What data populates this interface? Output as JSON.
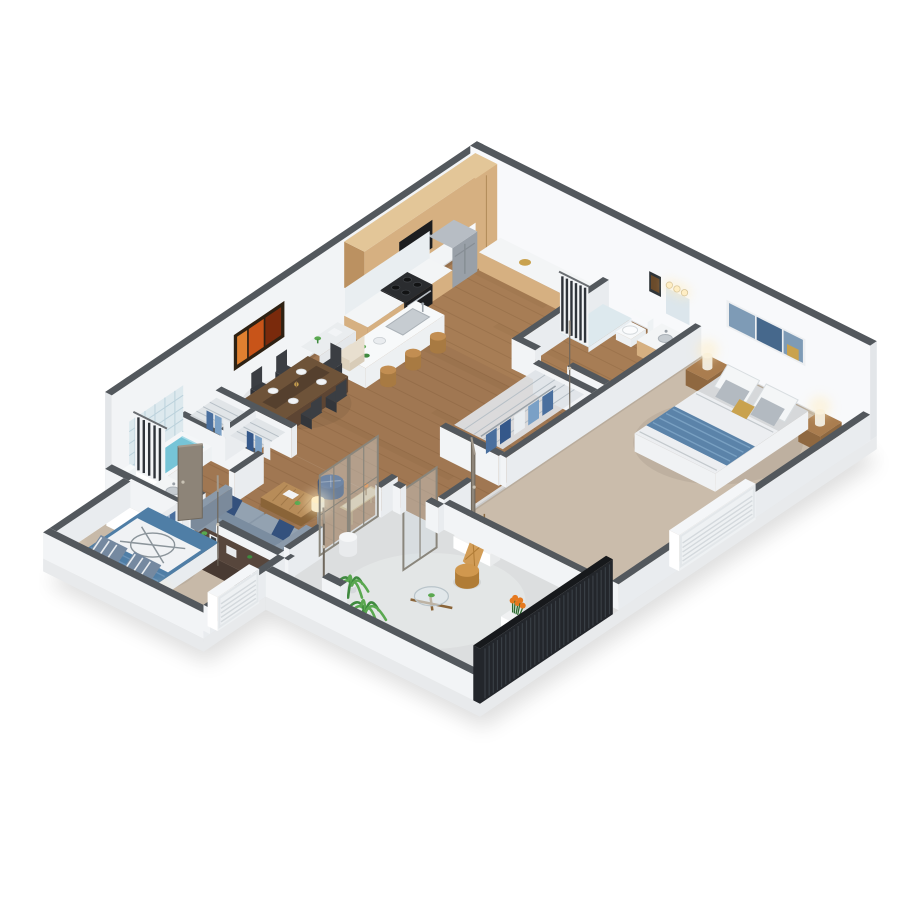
{
  "scene": {
    "kind": "3d-isometric-floor-plan-render",
    "background": "#ffffff",
    "palette": {
      "wallCap": "#53585d",
      "wallFace": "#f2f4f6",
      "wallFaceLit": "#f8f9fb",
      "wallInner": "#e9ecef",
      "wallSide": "#e3e6e9",
      "slabSide": "#e8eaec",
      "wood": "#a07752",
      "woodLite": "#c79a62",
      "woodLine": "#6b4a2a",
      "woodDark": "#7a5635",
      "carpet1": "#cabcab",
      "carpet2": "#c7b9a8",
      "concrete": "#dcdedf",
      "concreteLit": "#eaeceb",
      "oak": "#d6b081",
      "oakLight": "#e3c698",
      "oakDark": "#bb9161",
      "counter": "#f3f5f6",
      "steel": "#b7bdc4",
      "steelDark": "#99a0a8",
      "range": "#1c1d1f",
      "rangeTop": "#2a2c2f",
      "islandSide": "#edf0f2",
      "islandTop": "#f7f9fa",
      "sinkSteel": "#c6ccd1",
      "stool": "#c28e52",
      "stoolDark": "#a87a42",
      "tableWood": "#5d4533",
      "tableTop": "#6e5339",
      "chairDark": "#3b3e43",
      "marble": "#eaedef",
      "cream": "#e8dfcf",
      "sofaBase": "#8b9aaa",
      "sofaBack": "#7b8da0",
      "sofaSeat": "#93a2b1",
      "pillowNavy": "#34517d",
      "poufNavy": "#2e4d7e",
      "coffeeWood": "#b78c59",
      "coffeeDark": "#8a6438",
      "gold": "#ab8c60",
      "dresser": "#483a32",
      "dresserTop": "#57463c",
      "bedGray": "#d6d8da",
      "bedWhite": "#f0f2f4",
      "pillowWhite": "#f4f6f7",
      "pillowGray": "#b3bac1",
      "throwBlue": "#5b83a9",
      "blanketBlue": "#4f7ea6",
      "compassLine": "#8b949a",
      "pillowStripe": "#7589a0",
      "nstand": "#aa7d4f",
      "nstandDark": "#8f6840",
      "lampGlow": "#ffeec4",
      "lampWhite": "#f7f3ea",
      "door": "#8d8478",
      "doorDark": "#6f675c",
      "doorLight": "#a39a8d",
      "fence": "#23262b",
      "fenceHi": "#3e444b",
      "fenceCap": "#17191c",
      "water": "#76c4d7",
      "tile": "#dde9ee",
      "tileLine": "#bcd2dc",
      "curtainDark": "#2f343a",
      "curtainWhite": "#f2f4f6",
      "wire": "#dfe3e7",
      "wireLine": "#b6bfc6",
      "clothes": [
        "#4a6f9e",
        "#7aa0c6",
        "#e9edf0",
        "#35588a"
      ],
      "green": "#3f8a3f",
      "green2": "#5aa850",
      "greenDark": "#2e6b30",
      "flower": "#e5791f",
      "rattan": "#d0984e",
      "rattanDark": "#b07c36",
      "branch": "#8a6a42",
      "artOrange": [
        "#7a2a0c",
        "#c85419",
        "#e08030"
      ],
      "artOrangeFrame": "#2e2113",
      "artBlue": [
        "#7e9bb6",
        "#46688c",
        "#c9a24e"
      ],
      "artBlueFrame": "#edeff1",
      "mirror": "#dce6ec",
      "glass": "#d3dce0",
      "screenFrame": "#8a867c"
    },
    "rooms": [
      {
        "id": "kitchen",
        "name": "Kitchen"
      },
      {
        "id": "dining-area",
        "name": "Dining Area"
      },
      {
        "id": "living-room",
        "name": "Living Room"
      },
      {
        "id": "hallway",
        "name": "Hallway"
      },
      {
        "id": "bathroom-1",
        "name": "Bathroom 1"
      },
      {
        "id": "bathroom-2",
        "name": "Bathroom 2"
      },
      {
        "id": "hall-closet",
        "name": "Walk-in Closet"
      },
      {
        "id": "linen-closets",
        "name": "Linen Closets"
      },
      {
        "id": "master-bedroom",
        "name": "Master Bedroom"
      },
      {
        "id": "bedroom-2",
        "name": "Bedroom 2"
      },
      {
        "id": "entry",
        "name": "Entry"
      },
      {
        "id": "patio",
        "name": "Patio"
      }
    ],
    "furniture": [
      {
        "id": "refrigerator",
        "room": "kitchen"
      },
      {
        "id": "range-oven",
        "room": "kitchen"
      },
      {
        "id": "kitchen-cabinets",
        "room": "kitchen"
      },
      {
        "id": "upper-cabinets",
        "room": "kitchen"
      },
      {
        "id": "kitchen-island-with-sink",
        "room": "kitchen"
      },
      {
        "id": "bar-stools",
        "room": "kitchen",
        "count": 3
      },
      {
        "id": "writing-desk",
        "room": "dining-area"
      },
      {
        "id": "desk-chair",
        "room": "dining-area"
      },
      {
        "id": "dining-table",
        "room": "dining-area"
      },
      {
        "id": "dining-chairs",
        "room": "dining-area",
        "count": 6
      },
      {
        "id": "framed-art-orange",
        "room": "dining-area"
      },
      {
        "id": "sofa",
        "room": "living-room"
      },
      {
        "id": "ottoman-pouf",
        "room": "living-room"
      },
      {
        "id": "coffee-table",
        "room": "living-room"
      },
      {
        "id": "console-table",
        "room": "living-room"
      },
      {
        "id": "floor-lamp",
        "room": "living-room"
      },
      {
        "id": "queen-bed",
        "room": "master-bedroom"
      },
      {
        "id": "nightstands",
        "room": "master-bedroom",
        "count": 2
      },
      {
        "id": "table-lamps",
        "room": "master-bedroom",
        "count": 2
      },
      {
        "id": "framed-art-blue",
        "room": "master-bedroom"
      },
      {
        "id": "full-bed-compass-duvet",
        "room": "bedroom-2"
      },
      {
        "id": "dresser",
        "room": "bedroom-2"
      },
      {
        "id": "wardrobe",
        "room": "bedroom-2"
      },
      {
        "id": "bedside-lamps",
        "room": "bedroom-2",
        "count": 2
      },
      {
        "id": "bathtub",
        "room": "bathroom-2"
      },
      {
        "id": "shower-curtains",
        "count": 2
      },
      {
        "id": "toilets",
        "count": 2
      },
      {
        "id": "vanity-sinks",
        "count": 2
      },
      {
        "id": "vanity-mirror-lights",
        "room": "bathroom-1"
      },
      {
        "id": "wire-closet-shelving",
        "count": 3
      },
      {
        "id": "hanging-clothes",
        "count": 3
      },
      {
        "id": "louver-windows",
        "count": 2
      },
      {
        "id": "sliding-screen-doors",
        "count": 3
      },
      {
        "id": "interior-doors",
        "count": 5
      },
      {
        "id": "privacy-fence",
        "room": "patio"
      },
      {
        "id": "patio-chair",
        "room": "patio"
      },
      {
        "id": "patio-glass-table",
        "room": "patio"
      },
      {
        "id": "planter-box",
        "room": "patio"
      },
      {
        "id": "potted-palms",
        "count": 2
      },
      {
        "id": "flower-pot",
        "room": "patio"
      },
      {
        "id": "entry-stool",
        "room": "entry"
      }
    ]
  }
}
